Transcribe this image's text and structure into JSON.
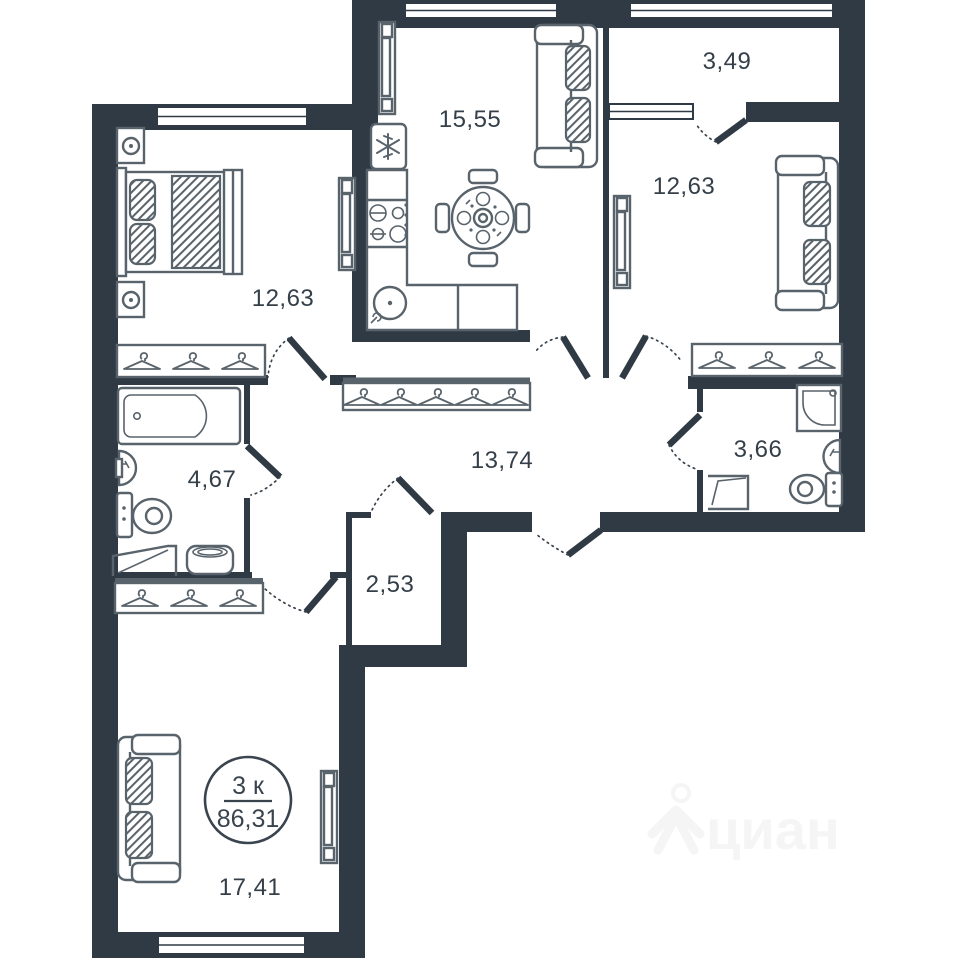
{
  "plan": {
    "badge": {
      "rooms": "3 к",
      "total_area": "86,31"
    },
    "rooms": [
      {
        "id": "kitchen-living",
        "area": "15,55"
      },
      {
        "id": "loggia",
        "area": "3,49"
      },
      {
        "id": "bedroom-right",
        "area": "12,63"
      },
      {
        "id": "bedroom-left",
        "area": "12,63"
      },
      {
        "id": "hallway",
        "area": "13,74"
      },
      {
        "id": "bathroom",
        "area": "4,67"
      },
      {
        "id": "wc-shower",
        "area": "3,66"
      },
      {
        "id": "storage",
        "area": "2,53"
      },
      {
        "id": "living-room",
        "area": "17,41"
      }
    ],
    "watermark": {
      "text": "циан"
    },
    "colors": {
      "wall": "#2f3a44",
      "furniture_stroke": "#59636b",
      "label": "#343f49",
      "watermark": "#f5f5f5",
      "background": "#ffffff"
    }
  }
}
